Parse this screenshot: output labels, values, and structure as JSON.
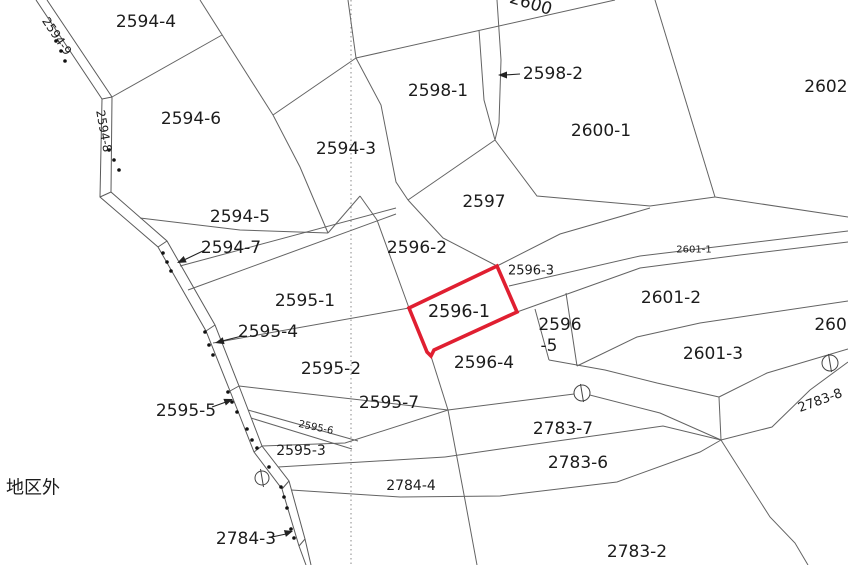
{
  "map": {
    "type": "cadastral-parcel-map",
    "highlighted_parcel": "2596-1",
    "highlight_color": "#e01f31",
    "line_color": "#636363",
    "background_color": "#ffffff",
    "outside_area_label": "地区外",
    "labels": [
      {
        "id": "2594-4",
        "text": "2594-4"
      },
      {
        "id": "2594-9",
        "text": "2594-9"
      },
      {
        "id": "2594-6",
        "text": "2594-6"
      },
      {
        "id": "2594-8",
        "text": "2594-8"
      },
      {
        "id": "2598-1",
        "text": "2598-1"
      },
      {
        "id": "2598-2",
        "text": "2598-2"
      },
      {
        "id": "2600",
        "text": "2600"
      },
      {
        "id": "2600-1",
        "text": "2600-1"
      },
      {
        "id": "2602-top",
        "text": "2602-"
      },
      {
        "id": "2594-3",
        "text": "2594-3"
      },
      {
        "id": "2594-5",
        "text": "2594-5"
      },
      {
        "id": "2594-7",
        "text": "2594-7"
      },
      {
        "id": "2597",
        "text": "2597"
      },
      {
        "id": "2596-2",
        "text": "2596-2"
      },
      {
        "id": "2596-3",
        "text": "2596-3"
      },
      {
        "id": "2601-1",
        "text": "2601-1"
      },
      {
        "id": "2595-1",
        "text": "2595-1"
      },
      {
        "id": "2596-1",
        "text": "2596-1"
      },
      {
        "id": "2601-2",
        "text": "2601-2"
      },
      {
        "id": "2602-right",
        "text": "2602"
      },
      {
        "id": "2595-4",
        "text": "2595-4"
      },
      {
        "id": "2596-5-line1",
        "text": "2596"
      },
      {
        "id": "2596-5-line2",
        "text": "-5"
      },
      {
        "id": "2595-2",
        "text": "2595-2"
      },
      {
        "id": "2596-4",
        "text": "2596-4"
      },
      {
        "id": "2601-3",
        "text": "2601-3"
      },
      {
        "id": "2595-5",
        "text": "2595-5"
      },
      {
        "id": "2595-7",
        "text": "2595-7"
      },
      {
        "id": "2783-8",
        "text": "2783-8"
      },
      {
        "id": "2595-6",
        "text": "2595-6"
      },
      {
        "id": "2595-3",
        "text": "2595-3"
      },
      {
        "id": "2783-7",
        "text": "2783-7"
      },
      {
        "id": "2783-6",
        "text": "2783-6"
      },
      {
        "id": "chikugai",
        "text": "地区外"
      },
      {
        "id": "2784-4",
        "text": "2784-4"
      },
      {
        "id": "2784-3",
        "text": "2784-3"
      },
      {
        "id": "2783-2",
        "text": "2783-2"
      }
    ]
  }
}
